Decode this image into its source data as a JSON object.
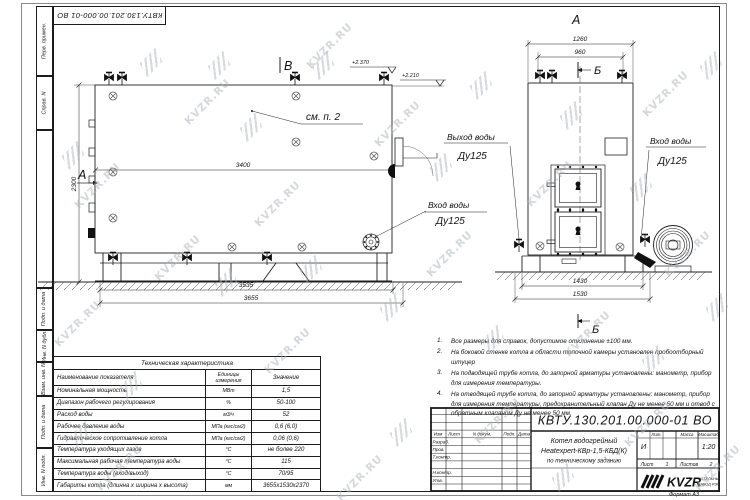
{
  "doc": {
    "number": "КВТУ.130.201.00.000-01 ВО",
    "format_label": "Формат  А3"
  },
  "watermark": {
    "text": "KVZR.RU"
  },
  "margin_labels": {
    "perv": "Перв. примен.",
    "sprav": "Справ. N",
    "podp1": "Подп. и дата",
    "inv_dubl": "Инв. N дубл.",
    "vzam": "Взам. инв. N",
    "podp2": "Подп. и дата",
    "inv_podl": "Инв. N подл."
  },
  "side_view": {
    "marker_left": "А",
    "marker_top": "В",
    "callout": "см. п. 2",
    "dim_length": "3400",
    "dim_height": "2300",
    "dim_frame": "3535",
    "dim_overall": "3655",
    "elev_top": "+2.370",
    "elev_low": "+2.210",
    "inlet_title": "Вход воды",
    "inlet_dn": "Ду125"
  },
  "front_view": {
    "title_marker": "А",
    "section_marker_top": "Б",
    "section_marker_bottom": "Б",
    "dim_top_outer": "1260",
    "dim_top_inner": "960",
    "dim_bottom_inner": "1430",
    "dim_bottom_outer": "1530",
    "outlet_title": "Выход воды",
    "outlet_dn": "Ду125",
    "inlet_title": "Вход воды",
    "inlet_dn": "Ду125"
  },
  "spec_table": {
    "title": "Техническая характеристика",
    "headers": [
      "Наименование показателя",
      "Единицы измерения",
      "Значение"
    ],
    "rows": [
      [
        "Номинальная мощность",
        "МВт",
        "1,5"
      ],
      [
        "Диапазон рабочего регулирования",
        "%",
        "50-100"
      ],
      [
        "Расход воды",
        "м3/ч",
        "52"
      ],
      [
        "Рабочее давление воды",
        "МПа (кгс/см2)",
        "0,6 (6,0)"
      ],
      [
        "Гидравлическое сопротивление котла",
        "МПа (кгс/см2)",
        "0,06 (0,6)"
      ],
      [
        "Температура уходящих газов",
        "°С",
        "не более 220"
      ],
      [
        "Максимальная рабочая температура воды",
        "°С",
        "115"
      ],
      [
        "Температура воды (вход/выход)",
        "°С",
        "70/95"
      ],
      [
        "Габариты котла (длинна х ширина х высота)",
        "мм",
        "3655х1530х2370"
      ]
    ]
  },
  "notes": {
    "n1": "1.",
    "t1": "Все размеры для справок, допустимое отклонение ±100 мм.",
    "n2": "2.",
    "t2": "На боковой стенке котла в области топочной камеры установлен пробоотборный штуцер",
    "n3": "3.",
    "t3": "На подводящей трубе котла, до запорной арматуры установлены: манометр, прибор для измерения температуры.",
    "n4": "4.",
    "t4": "На отводящей трубе котла, до запорной арматуры установлены: манометр, прибор для измерения температуры, предохранительный клапан Ду не менее 50 мм и отвод с обратным клапаном Ду не менее 50 мм."
  },
  "title_block": {
    "doc_number": "КВТУ.130.201.00.000-01 ВО",
    "col_izm": "Изм",
    "col_list": "Лист",
    "col_doc": "N докум.",
    "col_podp": "Подп.",
    "col_data": "Дата",
    "row_razrab": "Разраб.",
    "row_prov": "Пров.",
    "row_tkontr": "Т.контр.",
    "row_nkontr": "Н.контр.",
    "row_utv": "Утв.",
    "name_line1": "Котел водогрейный",
    "name_line2": "Heatexpert-КВр-1,5-КБД(К)",
    "name_line3": "по техническому заданию",
    "lit_header": "Лит.",
    "mass_header": "Масса",
    "scale_header": "Масштаб",
    "lit_value": "И",
    "scale_value": "1:20",
    "sheet_label": "Лист",
    "sheet_value": "1",
    "sheets_label": "Листов",
    "sheets_value": "2",
    "logo_text": "KVZR",
    "logo_line1": "КОТЕЛЬНЫЙ",
    "logo_line2": "ЗАВОД РЭП"
  }
}
